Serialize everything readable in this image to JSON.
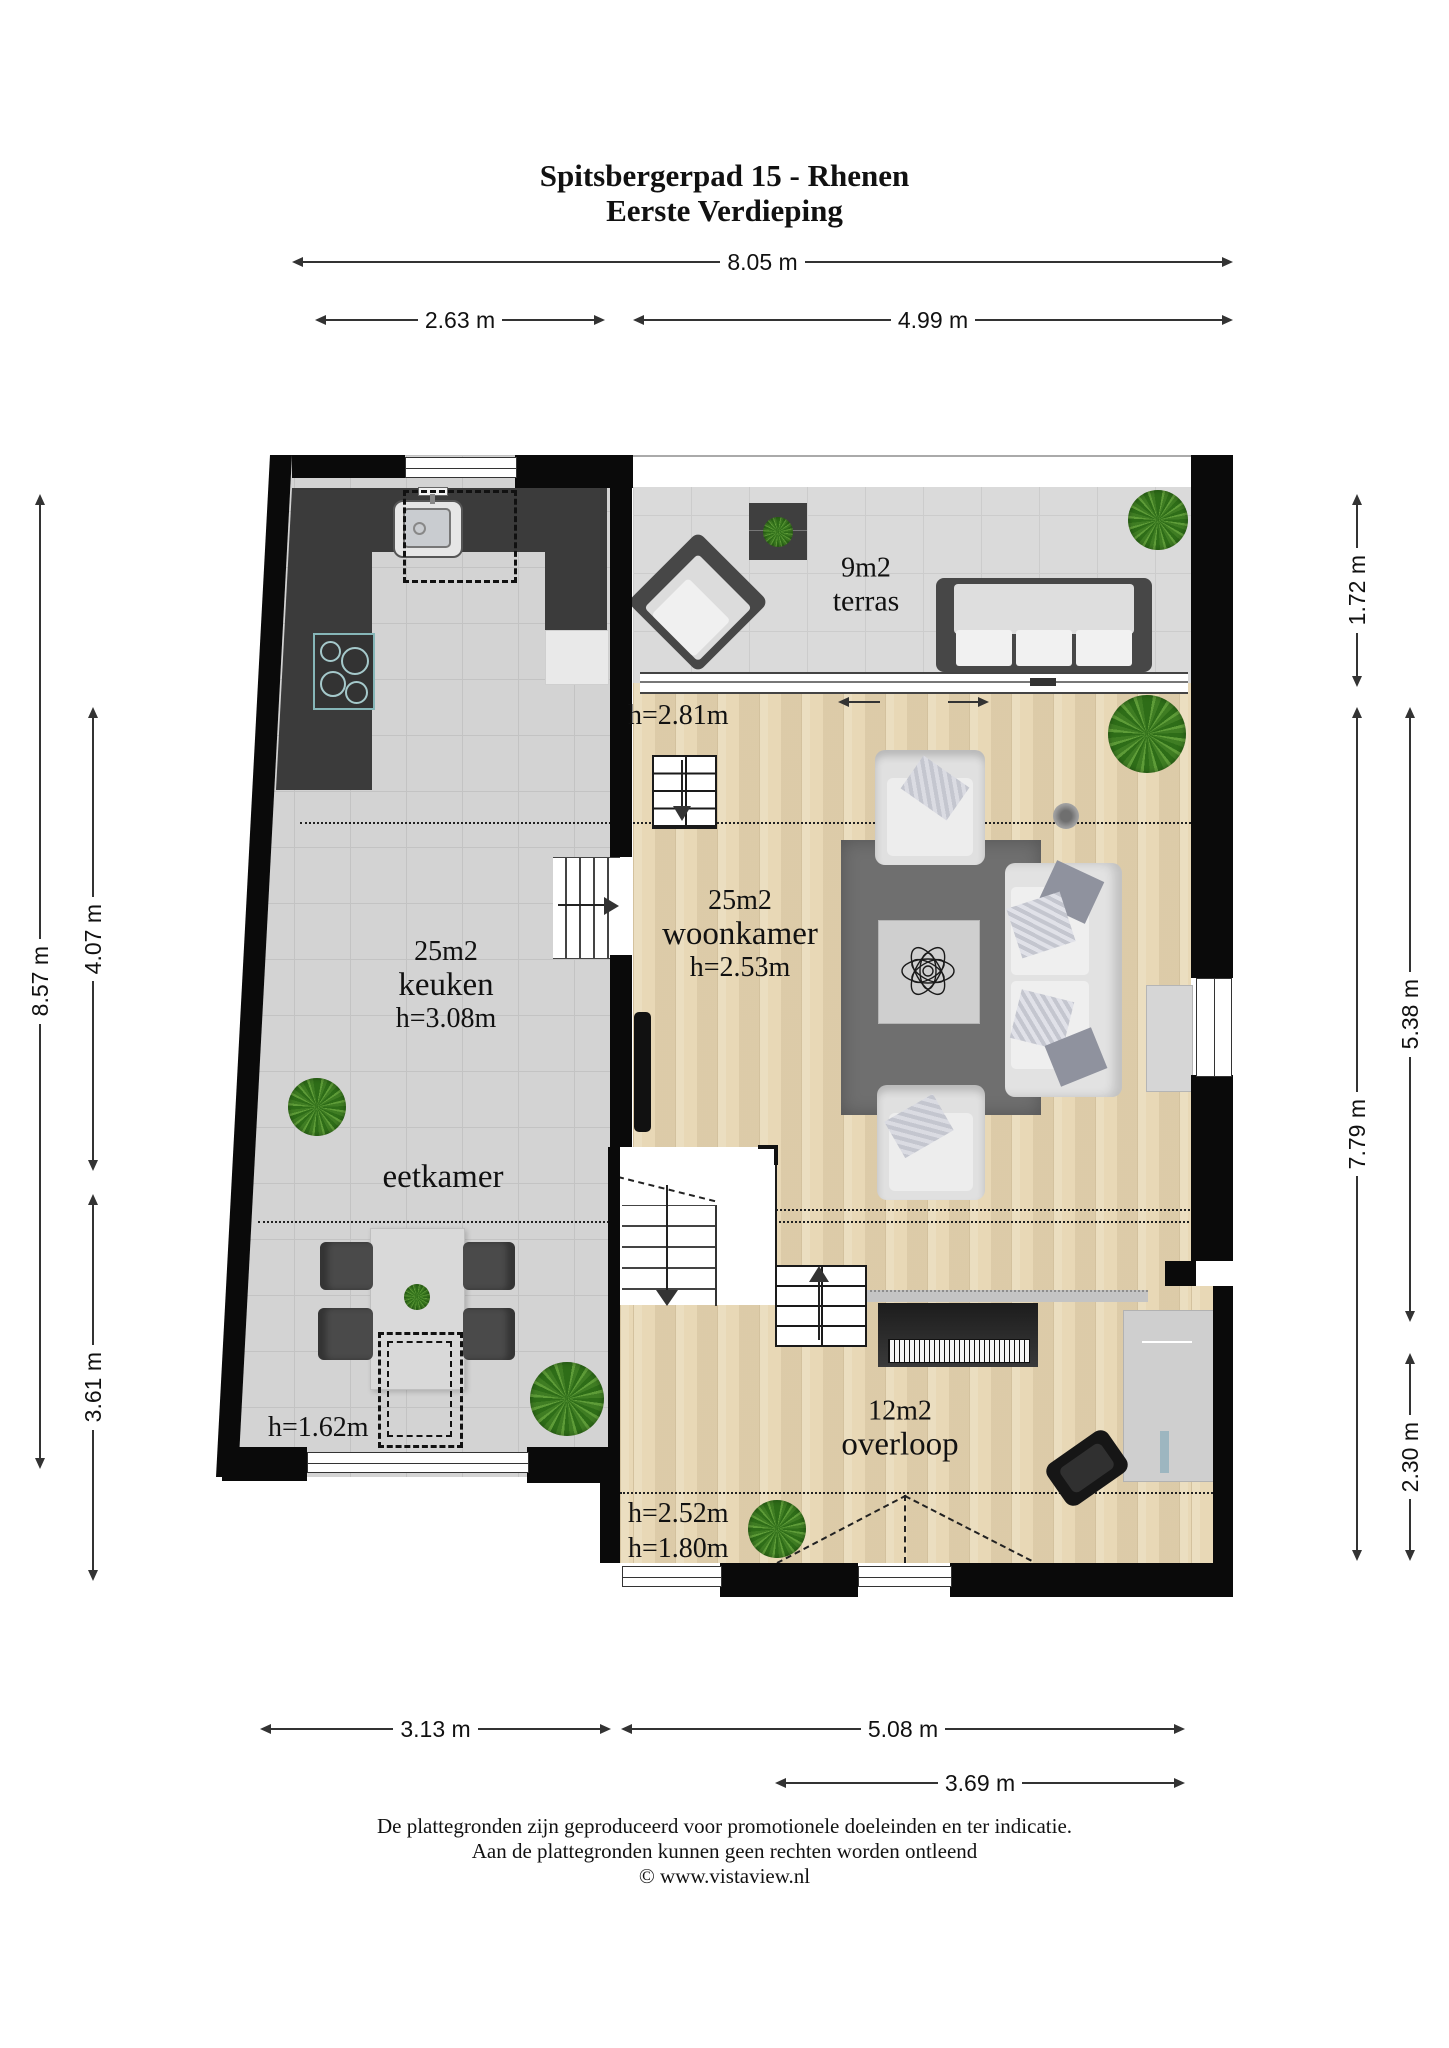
{
  "title": {
    "line1": "Spitsbergerpad 15 - Rhenen",
    "line2": "Eerste Verdieping"
  },
  "rooms": {
    "terras": {
      "area": "9m2",
      "name": "terras"
    },
    "woonkamer": {
      "area": "25m2",
      "name": "woonkamer",
      "height": "h=2.53m",
      "height_entry": "h=2.81m"
    },
    "keuken": {
      "area": "25m2",
      "name": "keuken",
      "height": "h=3.08m"
    },
    "eetkamer": {
      "name": "eetkamer",
      "height": "h=1.62m"
    },
    "overloop": {
      "area": "12m2",
      "name": "overloop",
      "height_a": "h=2.52m",
      "height_b": "h=1.80m"
    }
  },
  "dims": {
    "width_total": "8.05 m",
    "width_left": "2.63 m",
    "width_right": "4.99 m",
    "left_total": "8.57 m",
    "left_mid": "4.07 m",
    "left_lower": "3.61 m",
    "right_terras": "1.72 m",
    "right_main": "7.79 m",
    "right_upper": "5.38 m",
    "right_lower": "2.30 m",
    "bottom_left": "3.13 m",
    "bottom_right": "5.08 m",
    "bottom_inner": "3.69 m"
  },
  "footer": {
    "line1": "De plattegronden zijn geproduceerd voor promotionele doeleinden en ter indicatie.",
    "line2": "Aan de plattegronden kunnen geen rechten worden ontleend",
    "line3": "© www.vistaview.nl"
  },
  "colors": {
    "wall": "#0a0a0a",
    "tile_floor": "#d3d3d3",
    "terras_floor": "#dadada",
    "wood_floor": "#e8d8b6",
    "counter": "#3b3b3b",
    "rug": "#6f6f6f",
    "plant": "#3f7d23",
    "text": "#111111"
  }
}
